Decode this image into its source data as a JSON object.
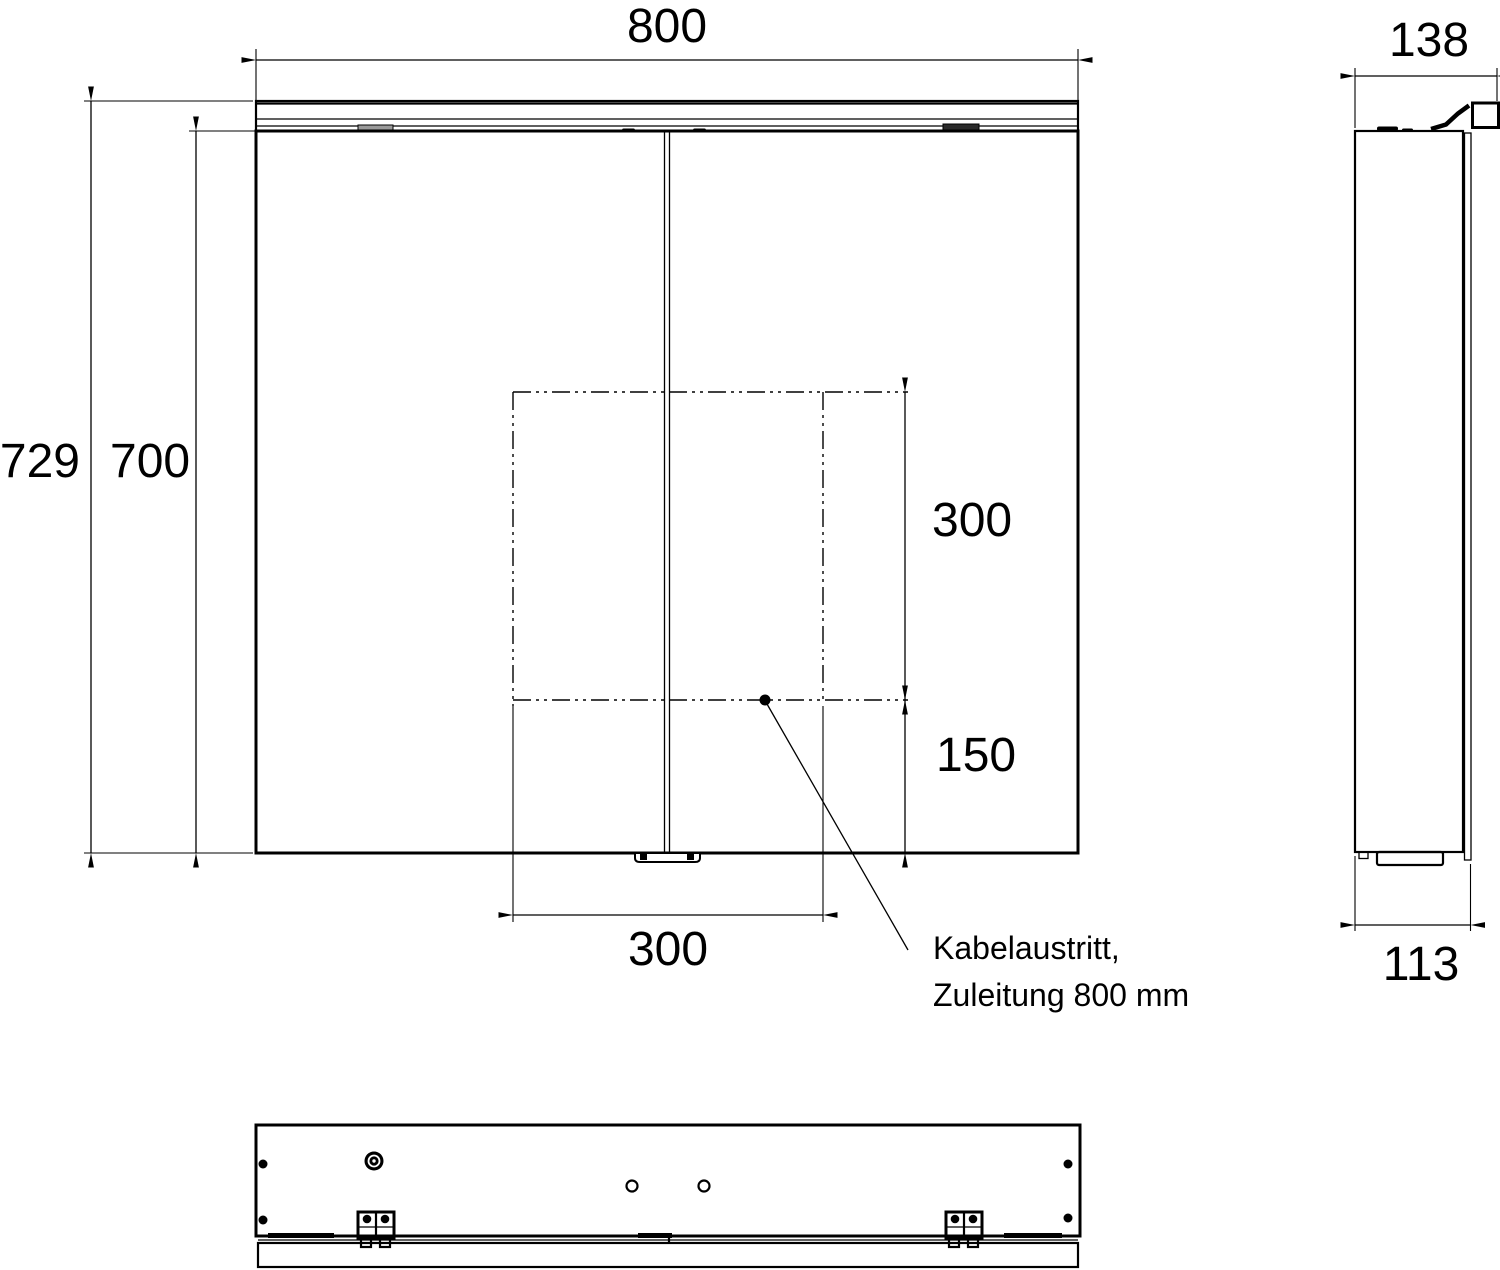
{
  "drawing": {
    "type": "technical-dimension-drawing",
    "background": "#ffffff",
    "line_color": "#000000",
    "views": {
      "front": "mirror cabinet front view, two doors with top light strip",
      "side": "side profile view with mounting bracket",
      "bottom": "bottom view with cable socket, holes and hinge clips"
    }
  },
  "dimensions": {
    "front_width": "800",
    "side_depth_total": "138",
    "front_height_total": "729",
    "front_height_doors": "700",
    "cutout_height": "300",
    "cutout_offset_bottom": "150",
    "cutout_width": "300",
    "side_depth_body": "113"
  },
  "annotation": {
    "callout_line1": "Kabelaustritt,",
    "callout_line2": "Zuleitung 800 mm"
  }
}
